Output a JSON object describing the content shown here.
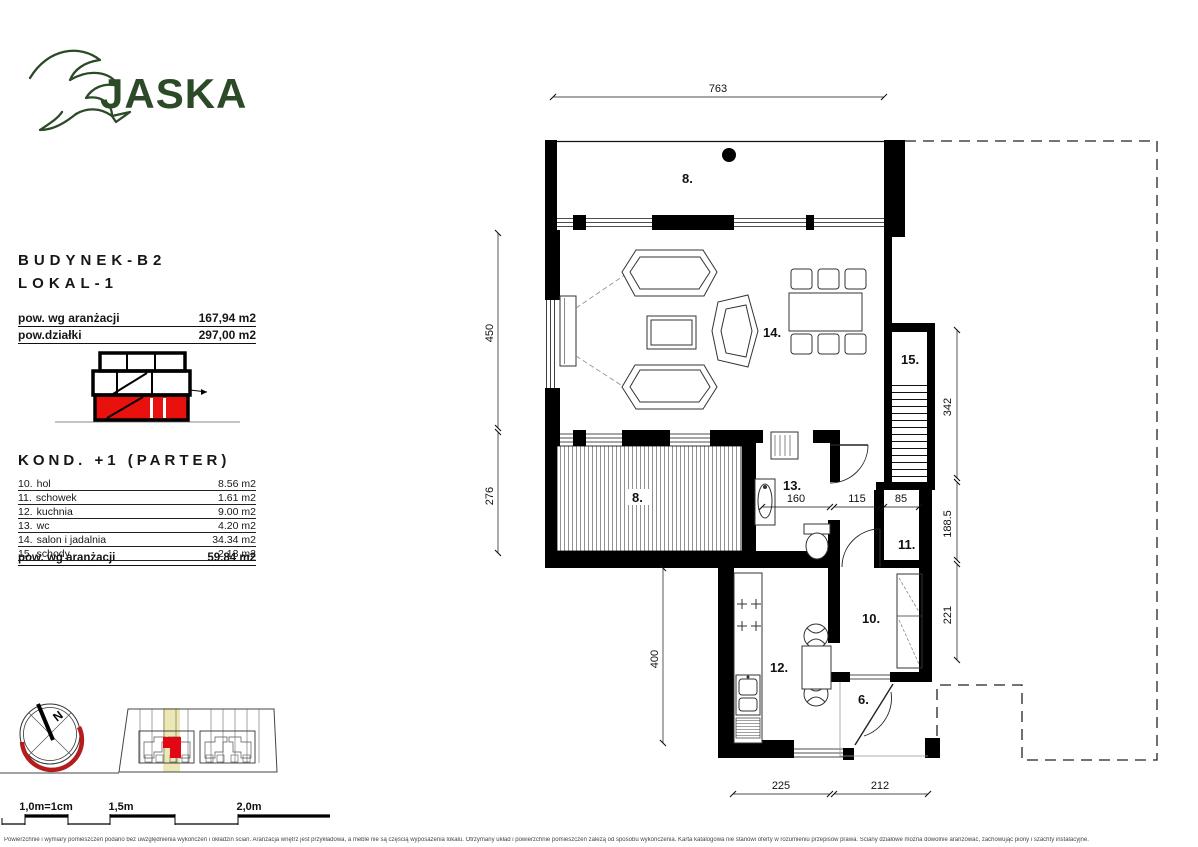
{
  "brand": {
    "name": "JASKA",
    "color": "#2d4a28"
  },
  "info": {
    "building": "BUDYNEK-B2",
    "unit": "LOKAL-1",
    "summary": [
      {
        "label": "pow. wg aranżacji",
        "value": "167,94 m2"
      },
      {
        "label": "pow.działki",
        "value": "297,00 m2"
      }
    ],
    "floor_title": "KOND. +1 (PARTER)",
    "rooms": [
      {
        "no": "10.",
        "name": "hol",
        "area": "8.56 m2"
      },
      {
        "no": "11.",
        "name": "schowek",
        "area": "1.61 m2"
      },
      {
        "no": "12.",
        "name": "kuchnia",
        "area": "9.00 m2"
      },
      {
        "no": "13.",
        "name": "wc",
        "area": "4.20 m2"
      },
      {
        "no": "14.",
        "name": "salon i jadalnia",
        "area": "34.34 m2"
      },
      {
        "no": "15.",
        "name": "schody",
        "area": "2.13 m2"
      }
    ],
    "total": {
      "label": "pow. wg aranżacji",
      "value": "59.84 m2"
    }
  },
  "plan": {
    "labels": {
      "terrace_top": "8.",
      "living": "14.",
      "stairs": "15.",
      "terrace_low": "8.",
      "wc": "13.",
      "storage": "11.",
      "hall": "10.",
      "kitchen": "12.",
      "porch": "6."
    },
    "dims": {
      "top": "763",
      "left_upper": "450",
      "left_lower": "276",
      "kitchen_left": "400",
      "right_upper": "342",
      "right_mid": "188.5",
      "right_lower": "221",
      "wc_width": "160",
      "corridor_width": "115",
      "storage_width": "85",
      "bottom_left": "225",
      "bottom_right": "212"
    },
    "wall_color": "#000000",
    "section_highlight_color": "#e8110d"
  },
  "compass": {
    "north": "N",
    "arc_color": "#b51d1d"
  },
  "scalebar": {
    "scale_note": "1,0m=1cm",
    "mid": "1,5m",
    "end": "2,0m",
    "note_color": "#c41e1e"
  },
  "footer": {
    "disclaimer": "Powierzchnie i wymiary pomieszczeń podano bez uwzględnienia wykończeń i okładzin ścian. Aranżacja wnętrz jest przykładowa, a meble nie są częścią wyposażenia lokalu. Otrzymany układ i powierzchnie pomieszczeń zależą od sposobu wykończenia. Karta katalogowa nie stanowi oferty w rozumieniu przepisów prawa. Ściany działowe można dowolnie aranżować, zachowując piony i szachty instalacyjne."
  }
}
